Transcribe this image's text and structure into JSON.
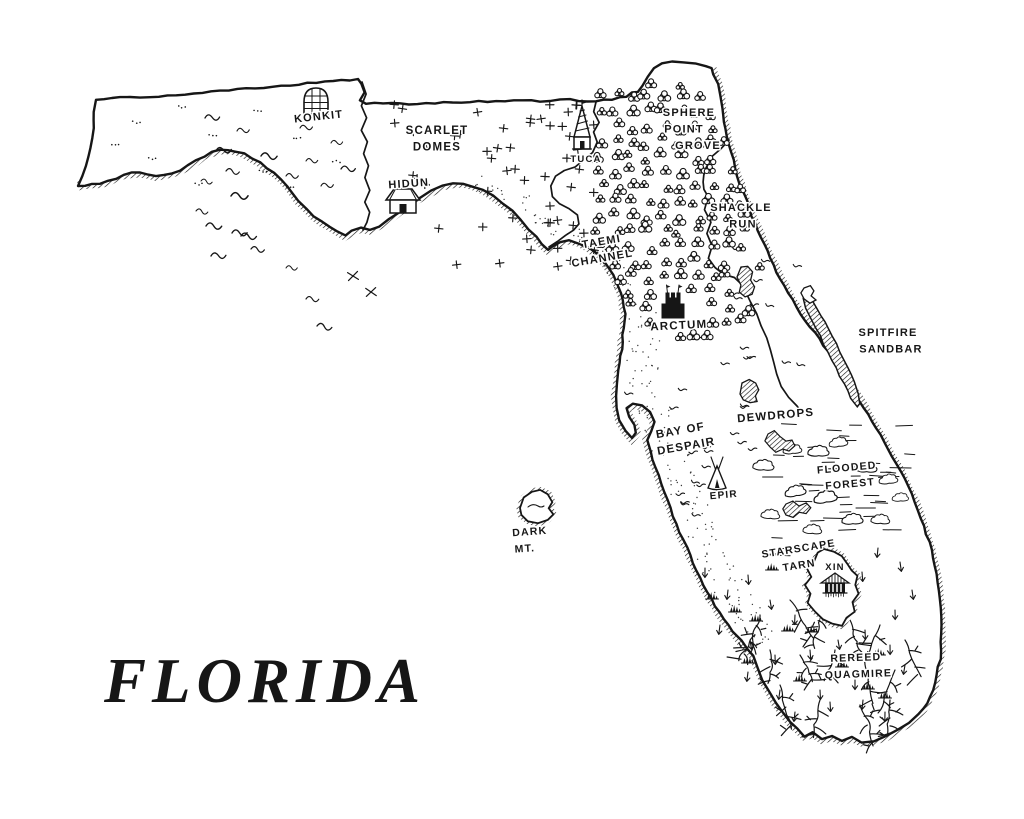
{
  "title": {
    "text": "FLORIDA"
  },
  "ink_color": "#161616",
  "paper_color": "#ffffff",
  "places": [
    {
      "id": "konkit",
      "name": "Konkit",
      "lines": [
        "KONKIT"
      ],
      "x": 319,
      "y": 120,
      "rot": -6,
      "size": 11,
      "icon": "dome-hut",
      "icon_x": 316,
      "icon_y": 101
    },
    {
      "id": "scarlet-domes",
      "name": "Scarlet Domes",
      "lines": [
        "SCARLET",
        "DOMES"
      ],
      "x": 437,
      "y": 134,
      "rot": 0,
      "size": 11.5
    },
    {
      "id": "hidun",
      "name": "Hidun",
      "lines": [
        "HIDUN"
      ],
      "x": 409,
      "y": 187,
      "rot": -4,
      "size": 11,
      "icon": "house",
      "icon_x": 403,
      "icon_y": 200
    },
    {
      "id": "tuca",
      "name": "Tuca",
      "lines": [
        "TUCA"
      ],
      "x": 586,
      "y": 162,
      "rot": 0,
      "size": 9.5,
      "icon": "tower",
      "icon_x": 582,
      "icon_y": 132
    },
    {
      "id": "sphere-point-grove",
      "name": "Sphere Point Grove",
      "lines": [
        "SPHERE",
        "POINT",
        "GROVE"
      ],
      "dx": [
        0,
        -5,
        9
      ],
      "x": 689,
      "y": 116,
      "rot": 0,
      "size": 11
    },
    {
      "id": "shackle-run",
      "name": "Shackle Run",
      "lines": [
        "SHACKLE",
        "RUN"
      ],
      "dx": [
        0,
        2
      ],
      "x": 741,
      "y": 211,
      "rot": 0,
      "size": 11
    },
    {
      "id": "taemi-channel",
      "name": "Taemi Channel",
      "lines": [
        "TAEMI",
        "CHANNEL"
      ],
      "dx": [
        0,
        -2
      ],
      "x": 602,
      "y": 245,
      "rot": -10,
      "size": 11
    },
    {
      "id": "arctum",
      "name": "Arctum",
      "lines": [
        "ARCTUM"
      ],
      "x": 679,
      "y": 329,
      "rot": -3,
      "size": 11.5,
      "icon": "castle",
      "icon_x": 673,
      "icon_y": 306
    },
    {
      "id": "spitfire-sandbar",
      "name": "Spitfire Sandbar",
      "lines": [
        "SPITFIRE",
        "SANDBAR"
      ],
      "dx": [
        0,
        3
      ],
      "x": 888,
      "y": 336,
      "rot": 0,
      "size": 11
    },
    {
      "id": "dewdrops",
      "name": "Dewdrops",
      "lines": [
        "DEWDROPS"
      ],
      "x": 776,
      "y": 419,
      "rot": -5,
      "size": 11.5
    },
    {
      "id": "bay-of-despair",
      "name": "Bay of Despair",
      "lines": [
        "BAY OF",
        "DESPAIR"
      ],
      "dx": [
        0,
        3
      ],
      "x": 681,
      "y": 434,
      "rot": -10,
      "size": 11.5
    },
    {
      "id": "epir",
      "name": "Epir",
      "lines": [
        "EPIR"
      ],
      "x": 724,
      "y": 498,
      "rot": -5,
      "size": 10,
      "icon": "teepee",
      "icon_x": 717,
      "icon_y": 475
    },
    {
      "id": "dark-mt",
      "name": "Dark Mt.",
      "lines": [
        "DARK",
        "MT."
      ],
      "dx": [
        0,
        -6
      ],
      "x": 530,
      "y": 535,
      "rot": -4,
      "size": 10.5
    },
    {
      "id": "flooded-forest",
      "name": "Flooded Forest",
      "lines": [
        "FLOODED",
        "FOREST"
      ],
      "dx": [
        0,
        2
      ],
      "x": 847,
      "y": 471,
      "rot": -5,
      "size": 10.5
    },
    {
      "id": "starscape-tarn",
      "name": "Starscape Tarn",
      "lines": [
        "STARSCAPE",
        "TARN"
      ],
      "dx": [
        0,
        -2
      ],
      "x": 799,
      "y": 552,
      "rot": -9,
      "size": 10.5
    },
    {
      "id": "xin",
      "name": "Xin",
      "lines": [
        "XIN"
      ],
      "x": 835,
      "y": 570,
      "rot": 0,
      "size": 9.5,
      "icon": "temple",
      "icon_x": 835,
      "icon_y": 587
    },
    {
      "id": "rereed-quagmire",
      "name": "Rereed Quagmire",
      "lines": [
        "REREED",
        "QUAGMIRE"
      ],
      "dx": [
        0,
        2
      ],
      "x": 856,
      "y": 661,
      "rot": -2,
      "size": 10.5
    }
  ]
}
